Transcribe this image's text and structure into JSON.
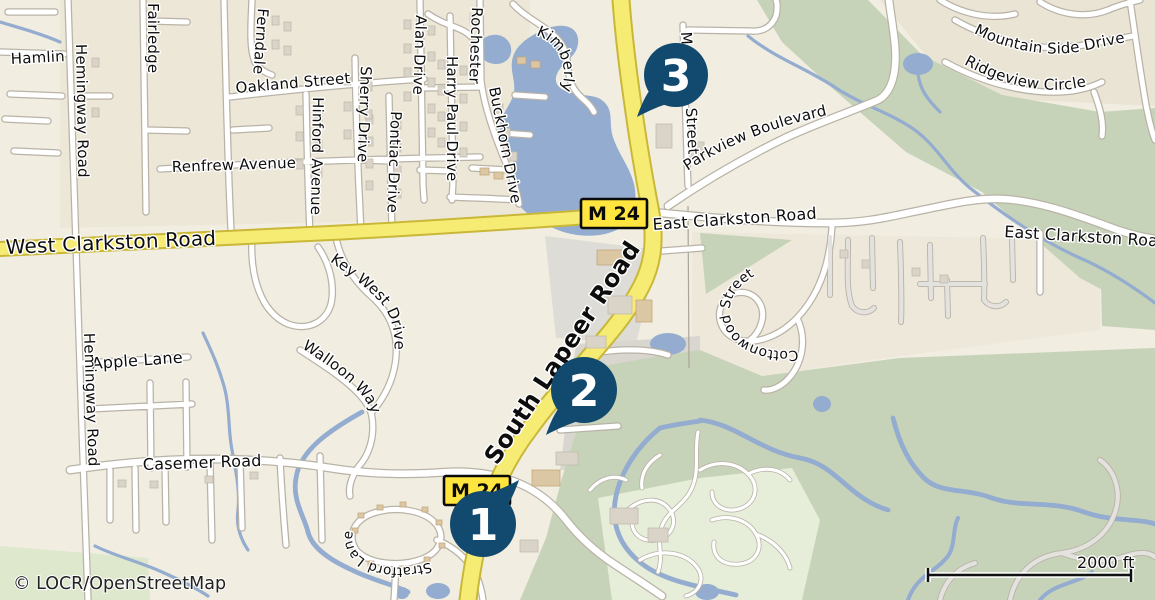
{
  "map": {
    "attribution": "© LOCR/OpenStreetMap",
    "scale_bar": {
      "label": "2000 ft"
    },
    "markers": [
      {
        "label": "1"
      },
      {
        "label": "2"
      },
      {
        "label": "3"
      }
    ],
    "route_shields": [
      {
        "label": "M 24"
      },
      {
        "label": "M 24"
      }
    ],
    "labels": {
      "hamlin": "Hamlin",
      "hemingway_road": "Hemingway Road",
      "hemingway_road_2": "Hemingway Road",
      "fairledge": "Fairledge",
      "ferndale": "Ferndale",
      "oakland_street": "Oakland Street",
      "sherry_drive": "Sherry Drive",
      "hinford_avenue": "Hinford Avenue",
      "renfrew_avenue": "Renfrew Avenue",
      "alan_drive": "Alan Drive",
      "pontiac_drive": "Pontiac Drive",
      "harry_paul_drive": "Harry Paul Drive",
      "rochester": "Rochester",
      "buckhorn_drive": "Buckhorn Drive",
      "kimberly": "Kimberly",
      "m_street_prefix": "M",
      "m_street_suffix": "Street",
      "parkview_boulevard": "Parkview Boulevard",
      "mountain_side_drive": "Mountain Side Drive",
      "ridgeview_circle": "Ridgeview Circle",
      "west_clarkston_road": "West Clarkston Road",
      "east_clarkston_road": "East Clarkston Road",
      "east_clarkston_road_2": "East Clarkston Road",
      "cottonwood_street": "Cottonwood Street",
      "key_west_drive": "Key West Drive",
      "walloon_way": "Walloon Way",
      "apple_lane": "Apple Lane",
      "casemer_road": "Casemer Road",
      "south_lapeer_road": "South Lapeer Road",
      "stratford_lane": "Stratford Lane"
    },
    "colors": {
      "land": "#f1ede1",
      "water": "#93accf",
      "forest": "#c7d3b9",
      "highway_fill": "#f7ec73",
      "highway_casing": "#c9b838",
      "shield_fill": "#ffe53e",
      "marker": "#114a6e",
      "building": "#d9d3c8"
    }
  }
}
